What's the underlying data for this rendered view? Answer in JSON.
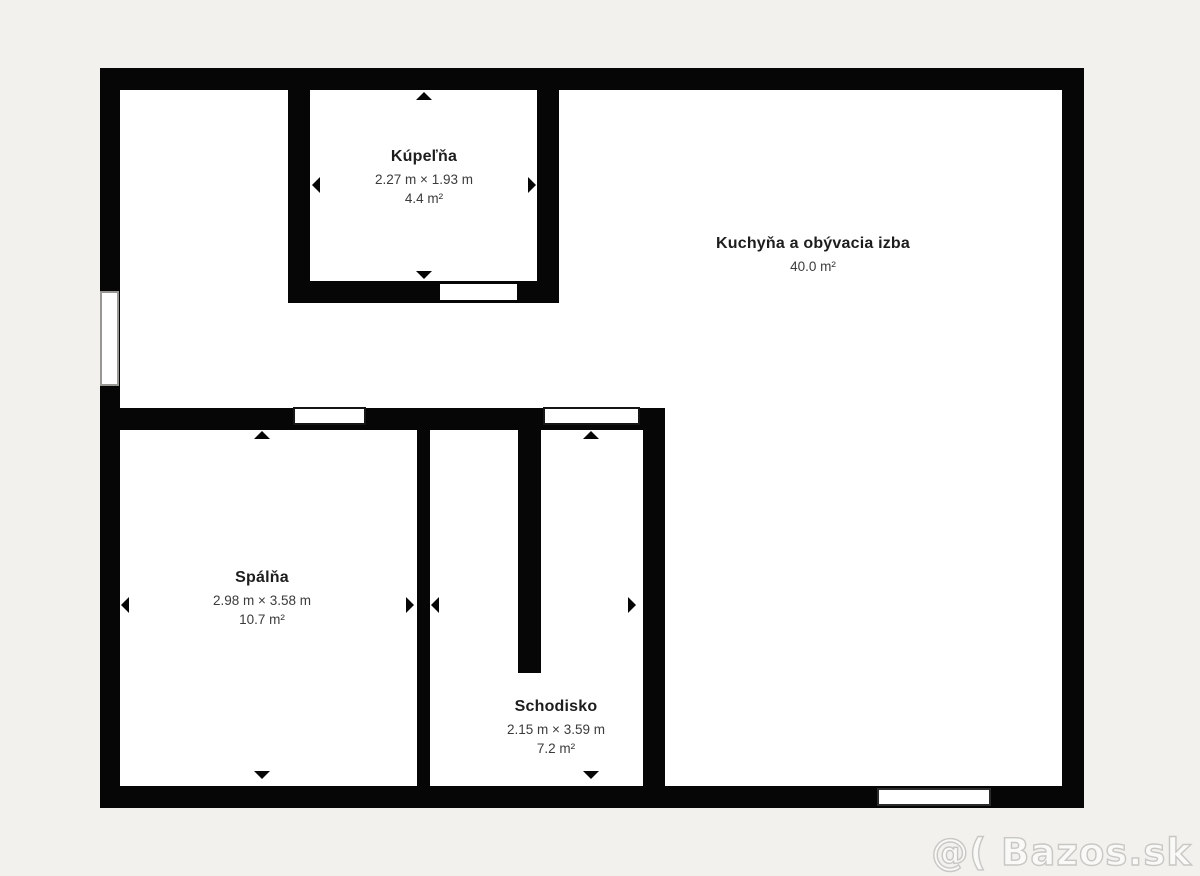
{
  "colors": {
    "background": "#f2f1ee",
    "wall": "#060606",
    "floor": "#ffffff",
    "room_name_text": "#1d1d1d",
    "room_dim_text": "#3b3b3b",
    "watermark_stroke": "#c8c7c4"
  },
  "rooms": {
    "kupelna": {
      "name": "Kúpeľňa",
      "dimensions": "2.27 m × 1.93 m",
      "area": "4.4 m²"
    },
    "kuchyna": {
      "name": "Kuchyňa a obývacia izba",
      "area": "40.0 m²"
    },
    "spalna": {
      "name": "Spálňa",
      "dimensions": "2.98 m × 3.58 m",
      "area": "10.7 m²"
    },
    "schodisko": {
      "name": "Schodisko",
      "dimensions": "2.15 m × 3.59 m",
      "area": "7.2 m²"
    }
  },
  "watermark": {
    "text": "@( Bazos.sk"
  }
}
